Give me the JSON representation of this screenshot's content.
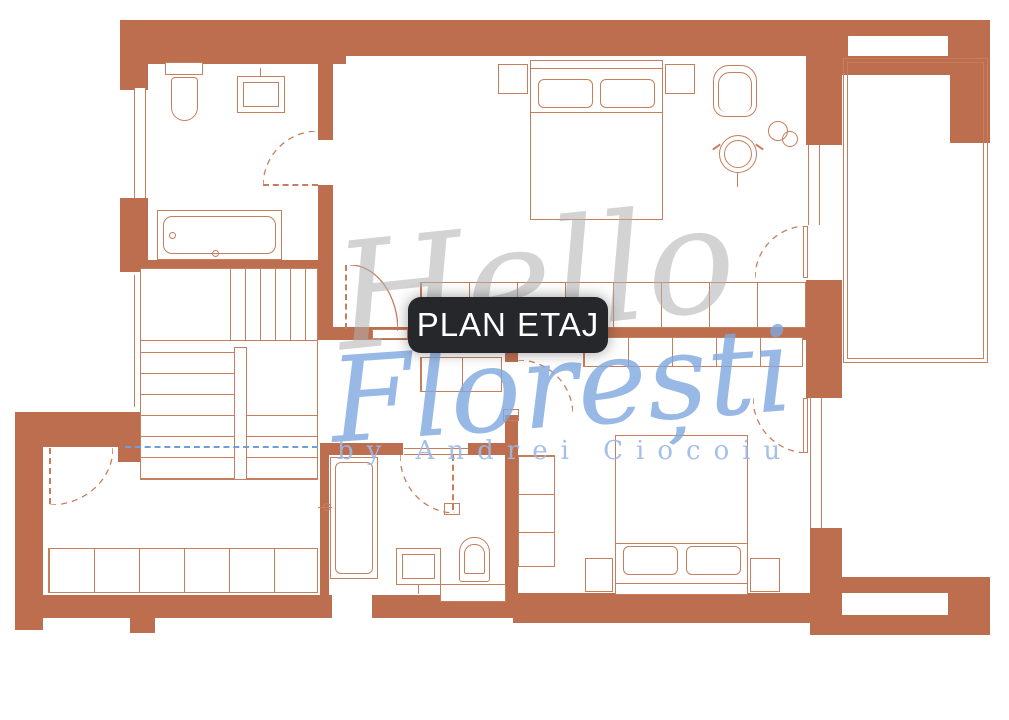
{
  "title_label": {
    "text": "PLAN ETAJ"
  },
  "watermark": {
    "word1": "Hello",
    "word2": "Florești",
    "byline": "by Andrei Ciocoiu"
  },
  "colors": {
    "wall": "#bd6e4f",
    "line": "#c67e5d",
    "label_bg": "#25272b",
    "label_text": "#ffffff",
    "watermark_gray": "#b0b0b0",
    "watermark_blue": "#7fa8df",
    "byline_blue": "#9db9e6",
    "section_blue": "#6f9fd8",
    "background": "#ffffff"
  },
  "legend": {
    "drawing_type": "floor-plan",
    "rooms": [
      "bathroom-upper",
      "bedroom-upper",
      "staircase",
      "hallway",
      "room-lower-left",
      "bathroom-lower",
      "bedroom-lower",
      "balcony"
    ],
    "furniture": [
      "toilet",
      "sink",
      "bathtub",
      "shower",
      "double-bed",
      "nightstand",
      "armchair",
      "round-table",
      "plant",
      "wardrobe",
      "stairs"
    ]
  }
}
